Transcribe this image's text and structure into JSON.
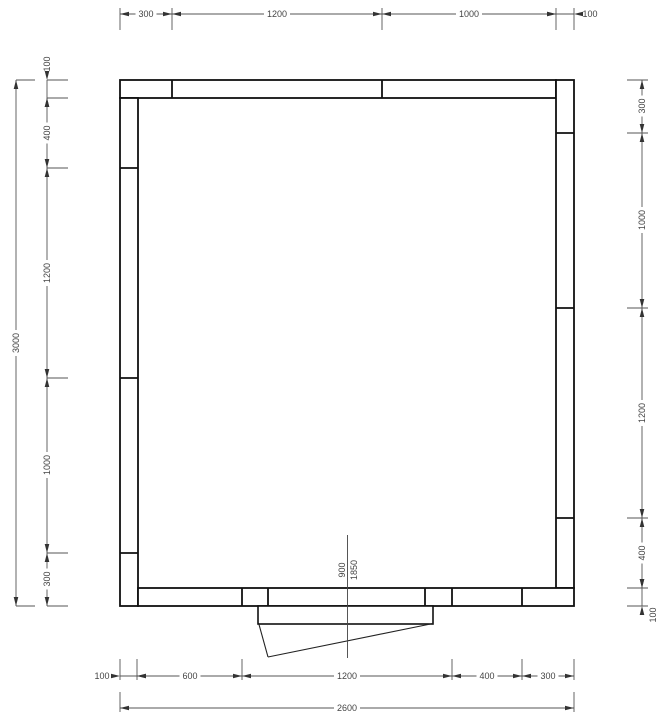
{
  "dimensions": {
    "top_chain": [
      "300",
      "1200",
      "1000",
      "100"
    ],
    "left_overall": "3000",
    "left_chain": [
      "100",
      "400",
      "1200",
      "1000",
      "300"
    ],
    "right_chain": [
      "300",
      "1000",
      "1200",
      "400",
      "100"
    ],
    "bottom_chain": [
      "100",
      "600",
      "1200",
      "400",
      "300"
    ],
    "bottom_overall": "2600",
    "door_width": "900",
    "door_height": "1850"
  },
  "colors": {
    "wall_line": "#111111",
    "dimension_line": "#555555",
    "arrow": "#333333",
    "text": "#444444",
    "background": "#ffffff"
  }
}
